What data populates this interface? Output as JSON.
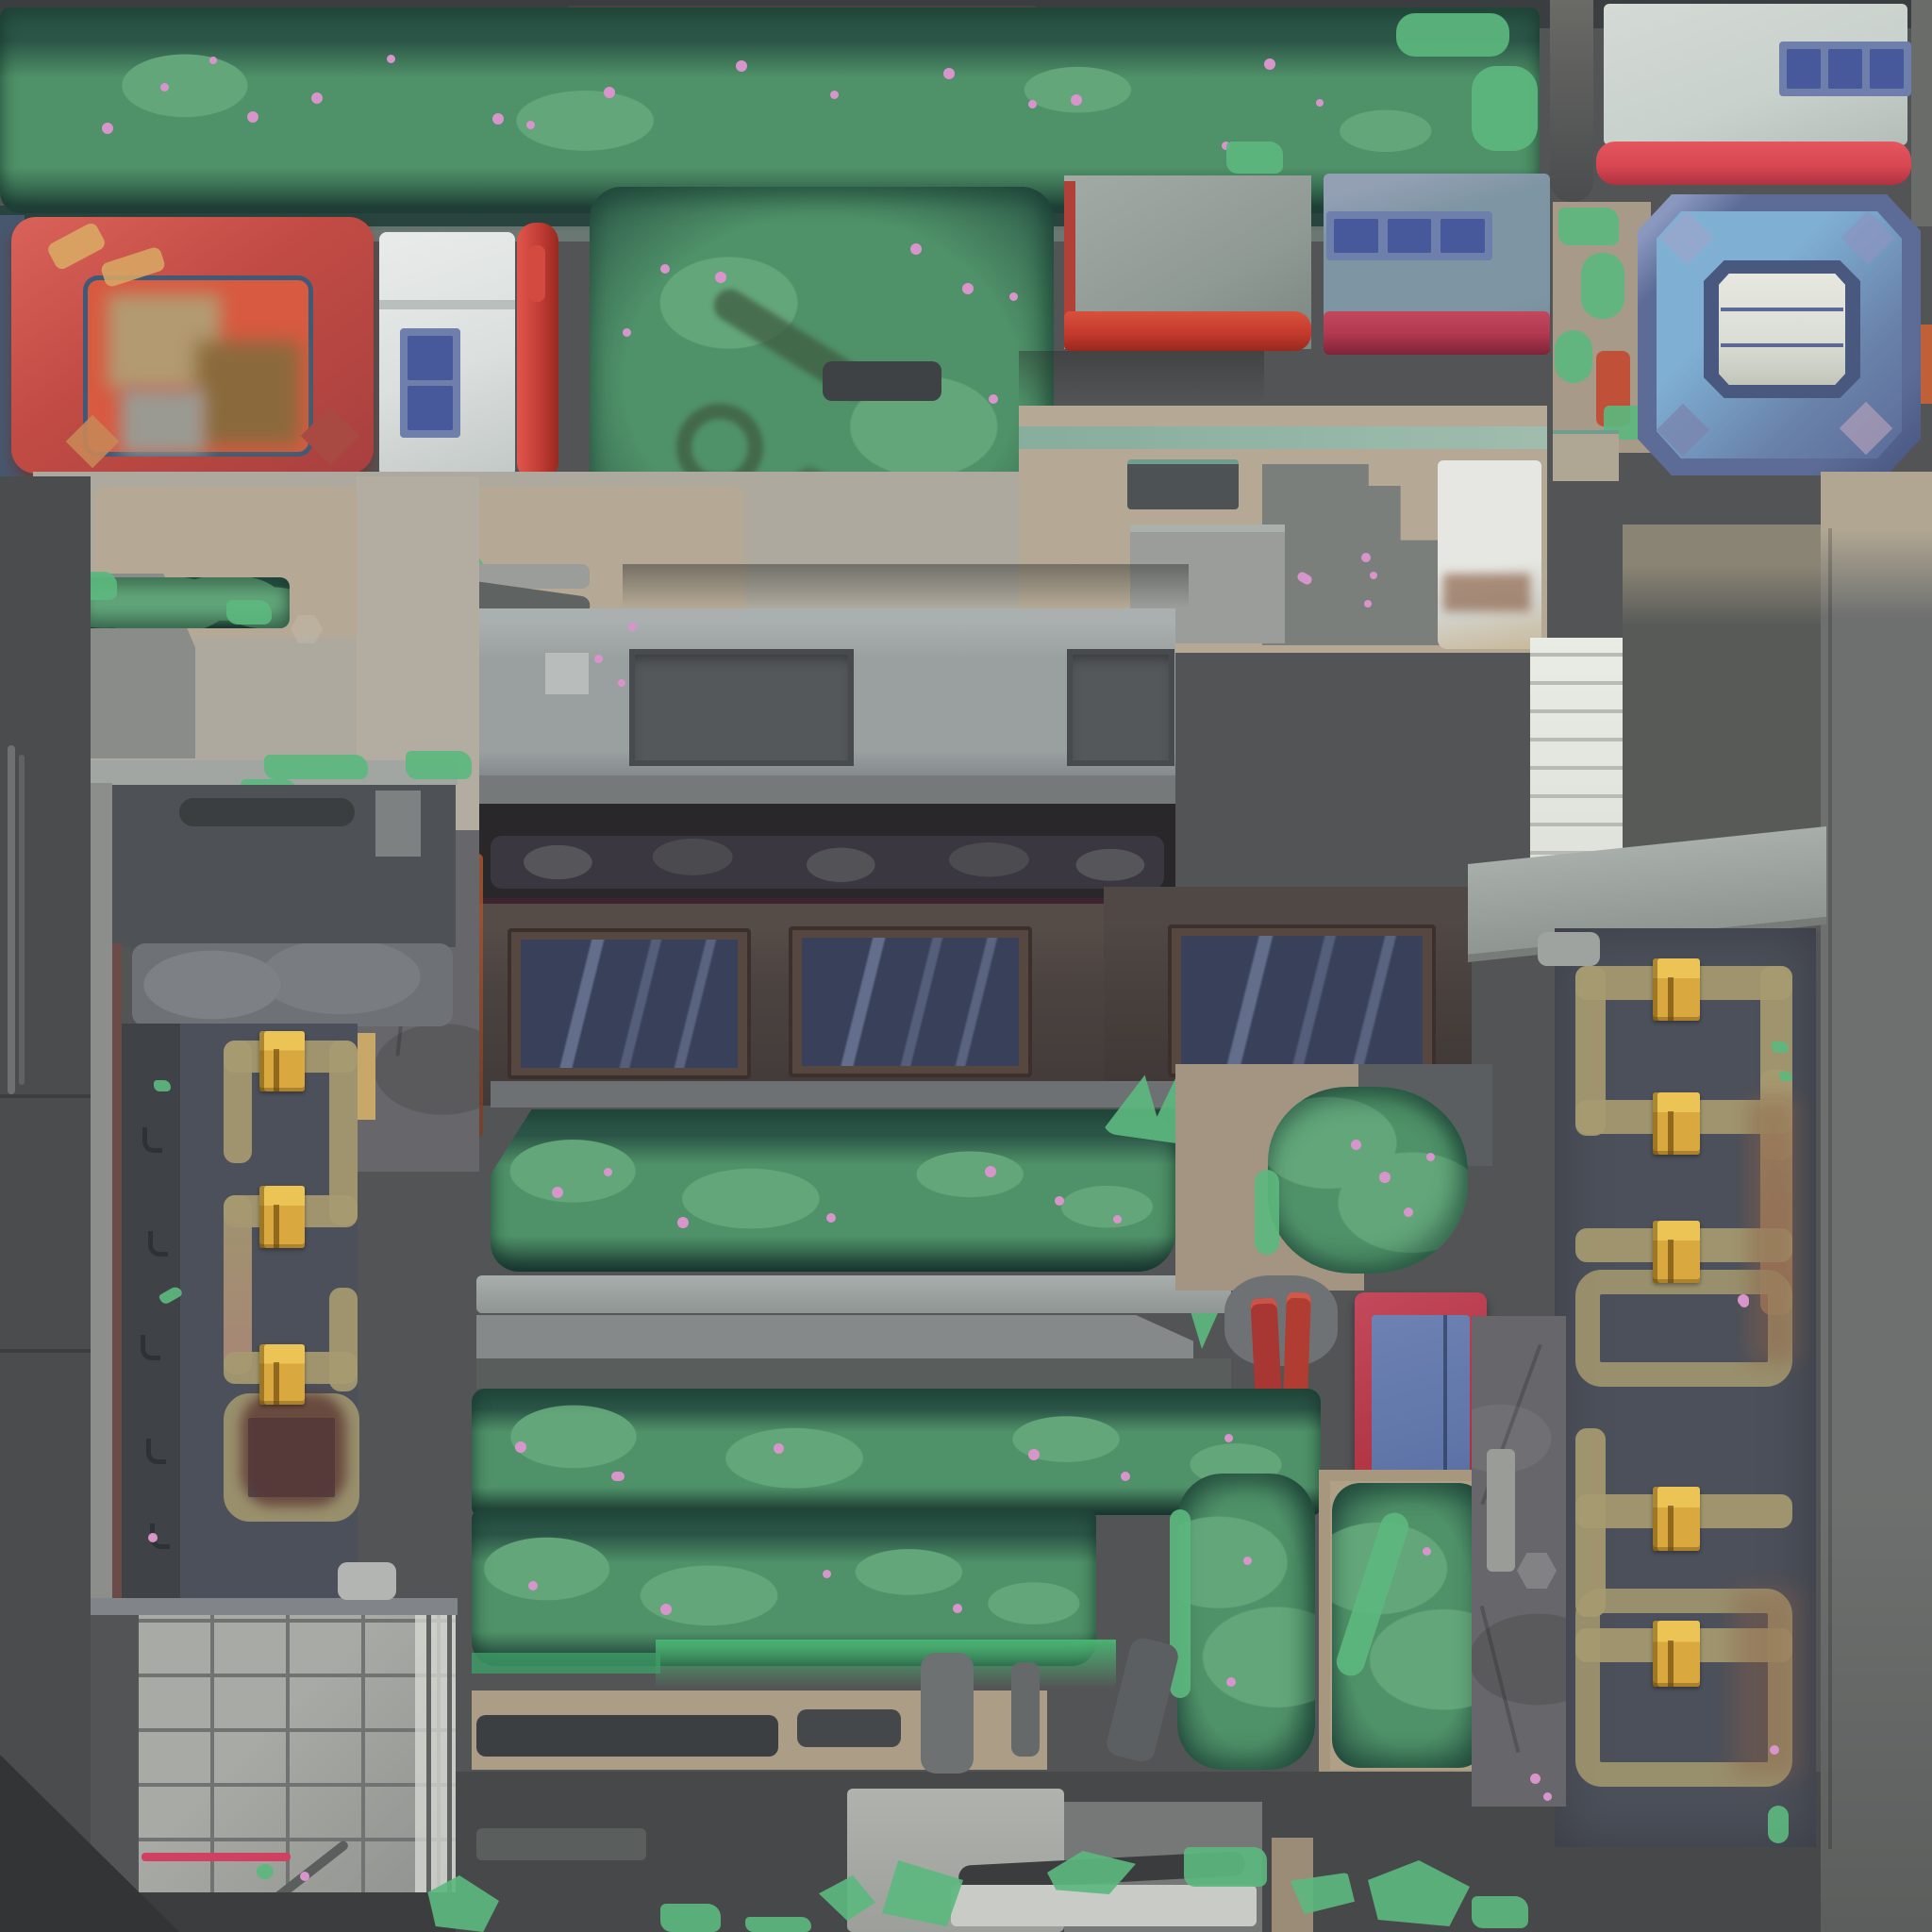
{
  "scene": {
    "name": "top-down-city-block-map-tile",
    "kind": "hand-painted top-down game environment texture",
    "visible_text": "none"
  },
  "palette": {
    "bg-gray": "#535456",
    "top-band": "#3a3e40",
    "hedge-mid": "#4f9168",
    "hedge-dark": "#2b5547",
    "hedge-light": "#63a67a",
    "hedge-deep": "#1f4038",
    "moss-mint": "#5cb77e",
    "flower-pink": "#d795cc",
    "branch-olive": "#47684e",
    "red-frame": "#c14b44",
    "red-frame-dark": "#a8403f",
    "gold-accent": "#d8a964",
    "interior-orange": "#d85a40",
    "interior-tan": "#b39a71",
    "kiosk-white": "#dbe0de",
    "pillar-red": "#c23c35",
    "bldg-gray": "#909a95",
    "stripe-orange-red": "#c43b2d",
    "bldg-blue-gray": "#7e95a3",
    "win-frame": "#6f7fab",
    "win-glass": "#47589b",
    "stripe-crimson": "#b23950",
    "light-bldg": "#c9d1cc",
    "stripe-red": "#d84752",
    "gem-outer": "#5c6c96",
    "gem-field": "#7fb0d4",
    "gem-ring": "#49587f",
    "gem-window": "#dbded6",
    "plaza-beige": "#aea99e",
    "plaza-tan": "#b5a995",
    "roof-band": "#9aa0a0",
    "vent-dark": "#54585a",
    "ridge-dark": "#2a272b",
    "facade-brown": "#4b4340",
    "facade-frame": "#574741",
    "facade-glass": "#39415a",
    "ledge-gray": "#75797a",
    "gold-bright": "#ecc355",
    "gold-mid": "#d9a83f",
    "orn-tan": "#a69a70",
    "panel-slate": "#4c505a",
    "stone-gray": "#67666a",
    "tile-gray": "#9b9e99",
    "tile-line": "#6f7371",
    "bottom-dark": "#47484a",
    "rust-brown": "#8a5f46",
    "door-red": "#b03442",
    "door-glass": "#5f74a8"
  },
  "regions": [
    "hedge-strip-top",
    "red-gate-roof",
    "street-kiosk",
    "red-pillar",
    "large-bush-planter",
    "gray-rooftop-red-stripe",
    "blue-gray-rooftop",
    "light-rooftop",
    "blue-gem-skylight",
    "plaza-concrete",
    "central-building-roof",
    "roof-vents",
    "facade-windows",
    "hedge-row-1",
    "walkway-rails",
    "hedge-row-2",
    "hedge-row-3",
    "round-bush",
    "red-framed-door",
    "red-handles",
    "bush-column",
    "framed-bush",
    "ornamental-gold-door-left",
    "ornamental-gold-door-right",
    "tile-grid-skylight",
    "stone-walls",
    "bottom-walkway",
    "moss-patches"
  ]
}
